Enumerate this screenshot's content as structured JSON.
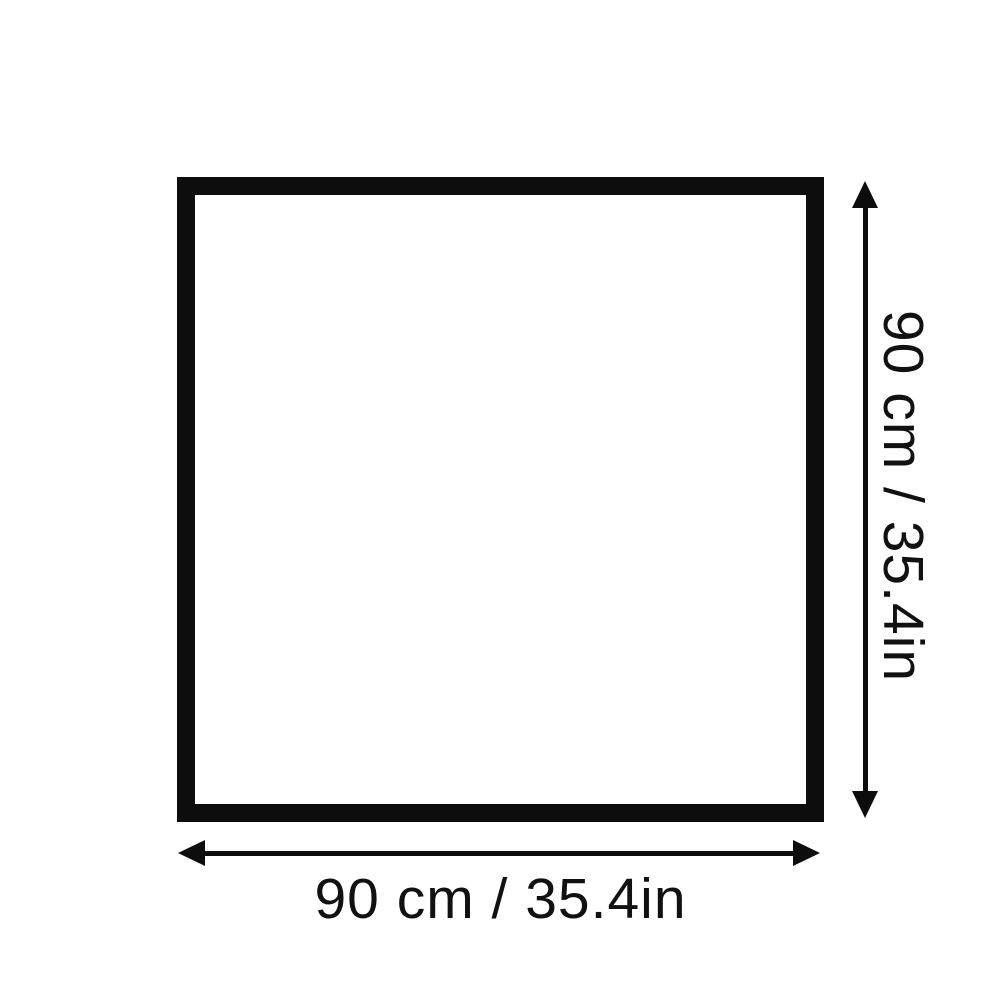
{
  "page": {
    "background_color": "#ffffff"
  },
  "diagram": {
    "type": "product-dimension-diagram",
    "shape": "square-outline",
    "outline_color": "#0d0d0d",
    "arrow_color": "#0d0d0d",
    "text_color": "#111111",
    "width_label": "90 cm / 35.4in",
    "height_label": "90 cm / 35.4in",
    "width_cm": 90,
    "width_in": 35.4,
    "height_cm": 90,
    "height_in": 35.4
  }
}
